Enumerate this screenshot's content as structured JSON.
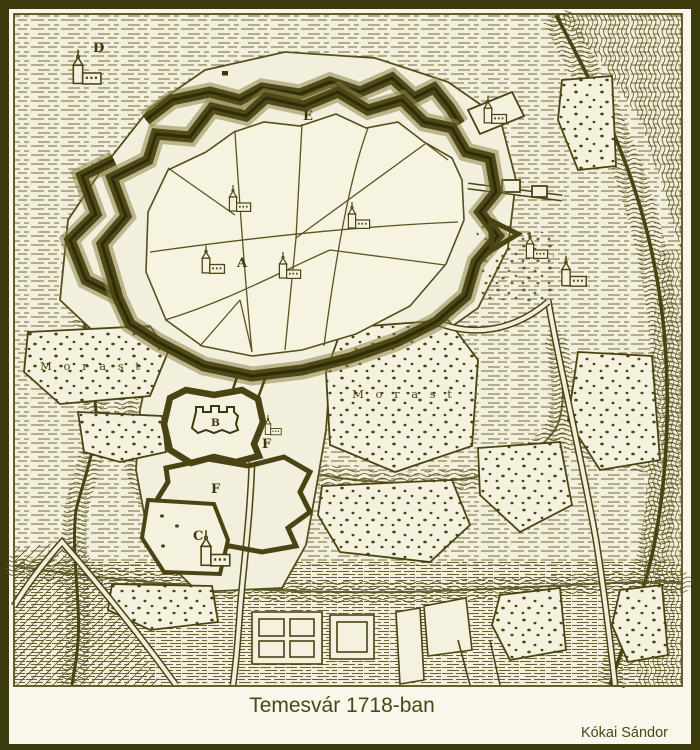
{
  "title": {
    "caption": "Temesvár 1718-ban",
    "author": "Kókai Sándor"
  },
  "map": {
    "labels": {
      "a": "A",
      "b": "B",
      "c": "C",
      "d": "D",
      "e": "E",
      "f_upper": "F",
      "f_lower": "F"
    },
    "region_labels": {
      "morast_west": "M o r a s t",
      "morast_center": "M o r a s t"
    },
    "features": {
      "city_label_meaning": "fortified inner city",
      "icon_church": "church-icon"
    },
    "colors": {
      "outer_border": "#3b3a0d",
      "paper_margin": "#f9f7ec",
      "map_paper": "#f2efdc",
      "ink": "#554f1c",
      "ink_dark": "#3c380c",
      "caption_text": "#464a12"
    }
  }
}
